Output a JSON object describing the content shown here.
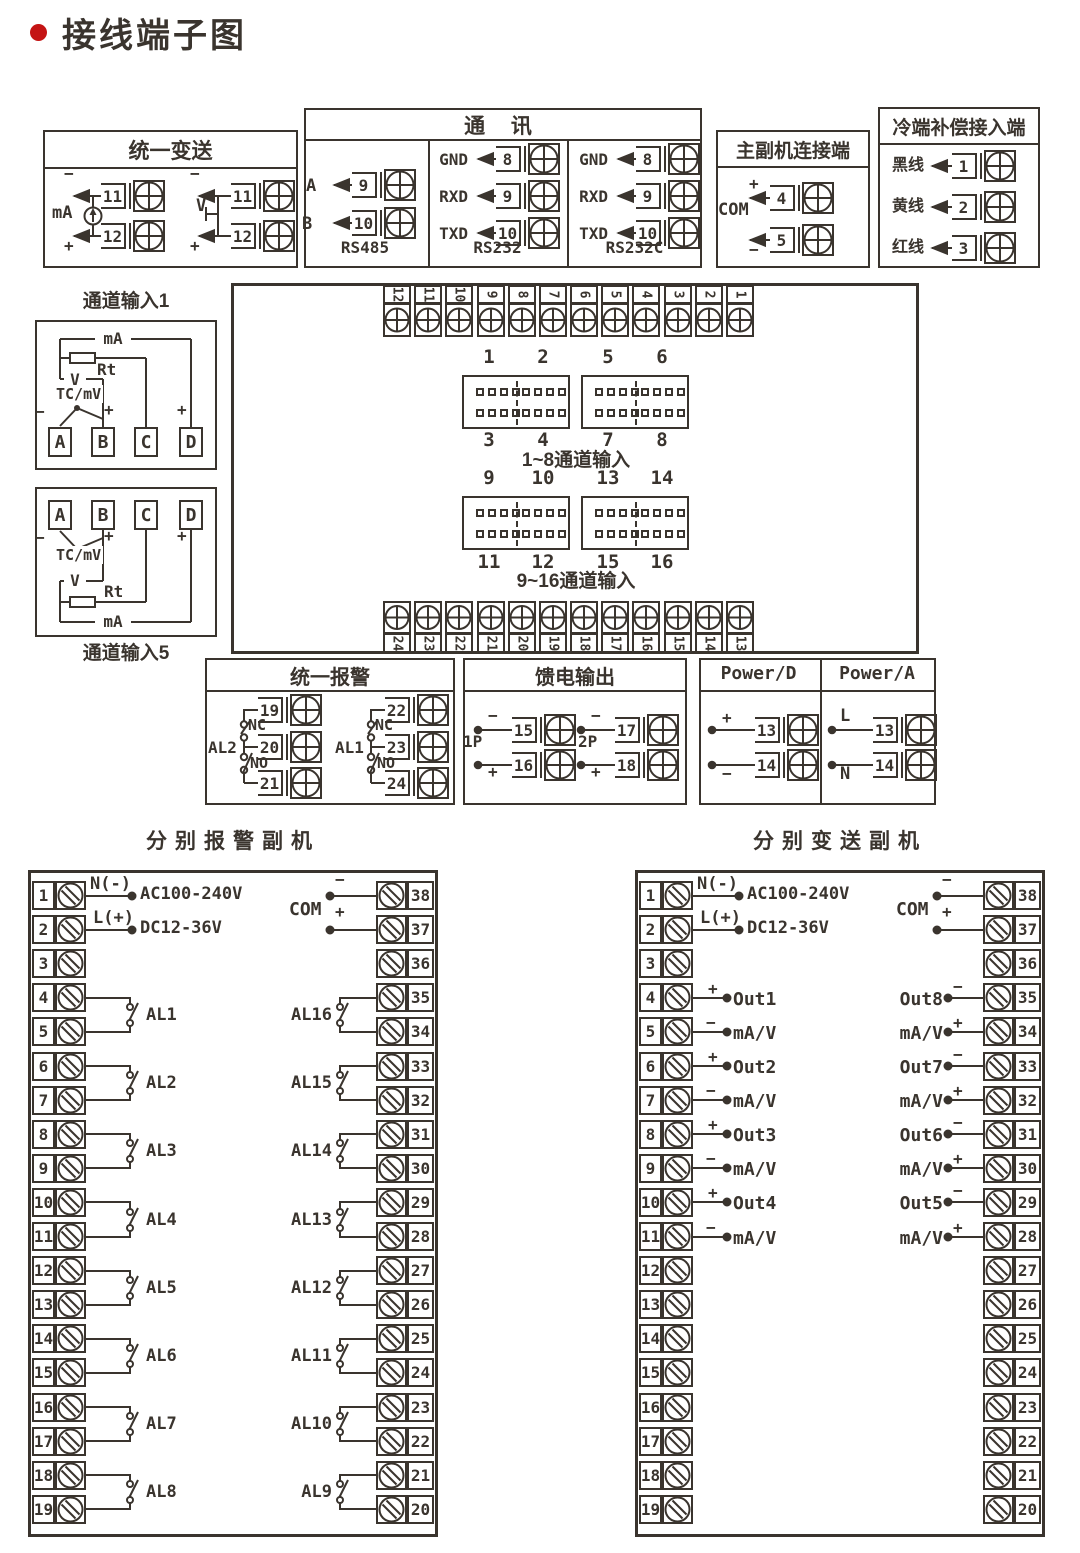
{
  "title": "接线端子图",
  "colors": {
    "line": "#3a342e",
    "accent": "#c41414"
  },
  "unified_transmit": {
    "title": "统一变送",
    "ma_label": "mA",
    "v_label": "V",
    "minus": "−",
    "plus": "+",
    "t11": "11",
    "t12": "12"
  },
  "comm": {
    "title": "通  讯",
    "cols": [
      {
        "caption": "RS485",
        "pins": [
          {
            "label": "A",
            "num": "9"
          },
          {
            "label": "B",
            "num": "10"
          }
        ]
      },
      {
        "caption": "RS232",
        "pins": [
          {
            "label": "GND",
            "num": "8"
          },
          {
            "label": "RXD",
            "num": "9"
          },
          {
            "label": "TXD",
            "num": "10"
          }
        ]
      },
      {
        "caption": "RS232C",
        "pins": [
          {
            "label": "GND",
            "num": "8"
          },
          {
            "label": "RXD",
            "num": "9"
          },
          {
            "label": "TXD",
            "num": "10"
          }
        ]
      }
    ]
  },
  "master_slave": {
    "title": "主副机连接端",
    "com": "COM",
    "plus": "+",
    "minus": "−",
    "t4": "4",
    "t5": "5"
  },
  "cold_comp": {
    "title": "冷端补偿接入端",
    "pins": [
      {
        "label": "黑线",
        "num": "1"
      },
      {
        "label": "黄线",
        "num": "2"
      },
      {
        "label": "红线",
        "num": "3"
      }
    ]
  },
  "channel1": {
    "title": "通道输入1",
    "ma": "mA",
    "rt": "Rt",
    "v": "V",
    "tc": "TC/mV",
    "minus": "−",
    "plus_b": "+",
    "plus_d": "+",
    "terminals": [
      "A",
      "B",
      "C",
      "D"
    ]
  },
  "channel5": {
    "title": "通道输入5",
    "ma": "mA",
    "rt": "Rt",
    "v": "V",
    "tc": "TC/mV",
    "minus": "−",
    "plus_b": "+",
    "plus_d": "+",
    "terminals": [
      "A",
      "B",
      "C",
      "D"
    ]
  },
  "board": {
    "top_strip": [
      "12",
      "11",
      "10",
      "9",
      "8",
      "7",
      "6",
      "5",
      "4",
      "3",
      "2",
      "1"
    ],
    "bottom_strip": [
      "24",
      "23",
      "22",
      "21",
      "20",
      "19",
      "18",
      "17",
      "16",
      "15",
      "14",
      "13"
    ],
    "groups": [
      {
        "top": [
          "1",
          "2",
          "5",
          "6"
        ],
        "bottom": [
          "3",
          "4",
          "7",
          "8"
        ],
        "caption": "1~8通道输入"
      },
      {
        "top": [
          "9",
          "10",
          "13",
          "14"
        ],
        "bottom": [
          "11",
          "12",
          "15",
          "16"
        ],
        "caption": "9~16通道输入"
      }
    ]
  },
  "unified_alarm": {
    "title": "统一报警",
    "relays": [
      {
        "name": "AL2",
        "nc": "NC",
        "no": "NO",
        "nums": [
          "19",
          "20",
          "21"
        ]
      },
      {
        "name": "AL1",
        "nc": "NC",
        "no": "NO",
        "nums": [
          "22",
          "23",
          "24"
        ]
      }
    ]
  },
  "feed_output": {
    "title": "馈电输出",
    "groups": [
      {
        "name": "1P",
        "minus": "−",
        "plus": "+",
        "nums": [
          "15",
          "16"
        ]
      },
      {
        "name": "2P",
        "minus": "−",
        "plus": "+",
        "nums": [
          "17",
          "18"
        ]
      }
    ]
  },
  "power": {
    "sections": [
      {
        "title": "Power/D",
        "top": "+",
        "bottom": "−",
        "nums": [
          "13",
          "14"
        ]
      },
      {
        "title": "Power/A",
        "top": "L",
        "bottom": "N",
        "nums": [
          "13",
          "14"
        ]
      }
    ]
  },
  "alarm_slave": {
    "title": "分别报警副机",
    "power": {
      "n": "N(-)",
      "l": "L(+)",
      "ac": "AC100-240V",
      "dc": "DC12-36V"
    },
    "com": {
      "label": "COM",
      "minus": "−",
      "plus": "+"
    },
    "left_nums": [
      "1",
      "2",
      "3",
      "4",
      "5",
      "6",
      "7",
      "8",
      "9",
      "10",
      "11",
      "12",
      "13",
      "14",
      "15",
      "16",
      "17",
      "18",
      "19"
    ],
    "right_nums": [
      "38",
      "37",
      "36",
      "35",
      "34",
      "33",
      "32",
      "31",
      "30",
      "29",
      "28",
      "27",
      "26",
      "25",
      "24",
      "23",
      "22",
      "21",
      "20"
    ],
    "left_relays": [
      "AL1",
      "AL2",
      "AL3",
      "AL4",
      "AL5",
      "AL6",
      "AL7",
      "AL8"
    ],
    "right_relays": [
      "AL16",
      "AL15",
      "AL14",
      "AL13",
      "AL12",
      "AL11",
      "AL10",
      "AL9"
    ]
  },
  "transmit_slave": {
    "title": "分别变送副机",
    "power": {
      "n": "N(-)",
      "l": "L(+)",
      "ac": "AC100-240V",
      "dc": "DC12-36V"
    },
    "com": {
      "label": "COM",
      "minus": "−",
      "plus": "+"
    },
    "left_nums": [
      "1",
      "2",
      "3",
      "4",
      "5",
      "6",
      "7",
      "8",
      "9",
      "10",
      "11",
      "12",
      "13",
      "14",
      "15",
      "16",
      "17",
      "18",
      "19"
    ],
    "right_nums": [
      "38",
      "37",
      "36",
      "35",
      "34",
      "33",
      "32",
      "31",
      "30",
      "29",
      "28",
      "27",
      "26",
      "25",
      "24",
      "23",
      "22",
      "21",
      "20"
    ],
    "left_outputs": [
      {
        "name": "Out1",
        "sub": "mA/V",
        "top": "+",
        "bottom": "−"
      },
      {
        "name": "Out2",
        "sub": "mA/V",
        "top": "+",
        "bottom": "−"
      },
      {
        "name": "Out3",
        "sub": "mA/V",
        "top": "+",
        "bottom": "−"
      },
      {
        "name": "Out4",
        "sub": "mA/V",
        "top": "+",
        "bottom": "−"
      }
    ],
    "right_outputs": [
      {
        "name": "Out8",
        "sub": "mA/V",
        "top": "−",
        "bottom": "+"
      },
      {
        "name": "Out7",
        "sub": "mA/V",
        "top": "−",
        "bottom": "+"
      },
      {
        "name": "Out6",
        "sub": "mA/V",
        "top": "−",
        "bottom": "+"
      },
      {
        "name": "Out5",
        "sub": "mA/V",
        "top": "−",
        "bottom": "+"
      }
    ]
  }
}
